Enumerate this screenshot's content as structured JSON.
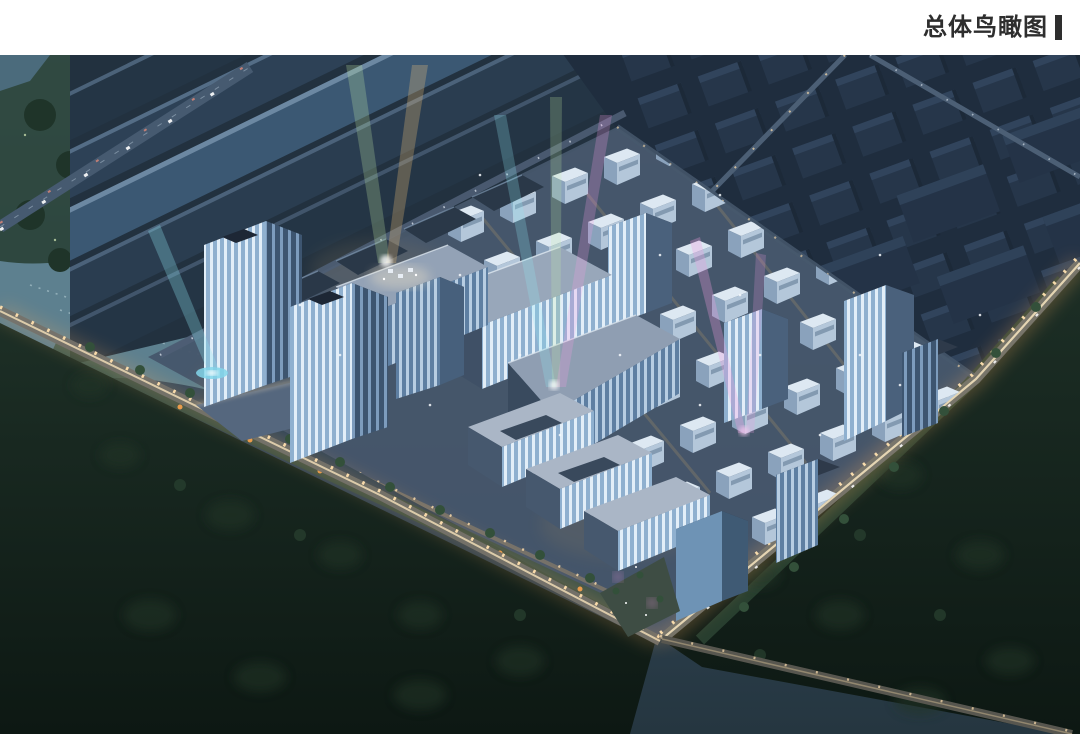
{
  "header": {
    "title": "总体鸟瞰图"
  },
  "colors": {
    "page_bg": "#ffffff",
    "title_text": "#2e2e2e",
    "title_accent": "#2e2e2e",
    "sky_top": "#4f6277",
    "sky_mid": "#344a5e",
    "sky_low": "#253640",
    "water": "#5d808f",
    "water_sparkle": "#c6dde2",
    "bank_green": "#2c4538",
    "tree_green": "#1f3429",
    "forest_top": "#1d2f26",
    "forest_bottom": "#0d1813",
    "shed_dark": "#243545",
    "shed_mid": "#2d4156",
    "shed_light": "#3b5873",
    "context_block": "#26364a",
    "context_top": "#31445c",
    "campus_ground": "#46566b",
    "lawn": "#3a523e",
    "roof_light": "#a2b0c2",
    "roof_dark": "#2b3646",
    "facade_bright": "#e2eef8",
    "facade_mid": "#b7cde2",
    "facade_shadow": "#8aa2bc",
    "road_surface": "#75726a",
    "road_glow": "#f2a85c",
    "road_core": "#f6e2ba",
    "street_light": "#ffdfae",
    "beam_green": "#c8f0a8",
    "beam_cyan": "#8fe6f2",
    "beam_magenta": "#f29ae2",
    "beam_warm": "#f8c67a",
    "fountain": "#82d6ea"
  }
}
